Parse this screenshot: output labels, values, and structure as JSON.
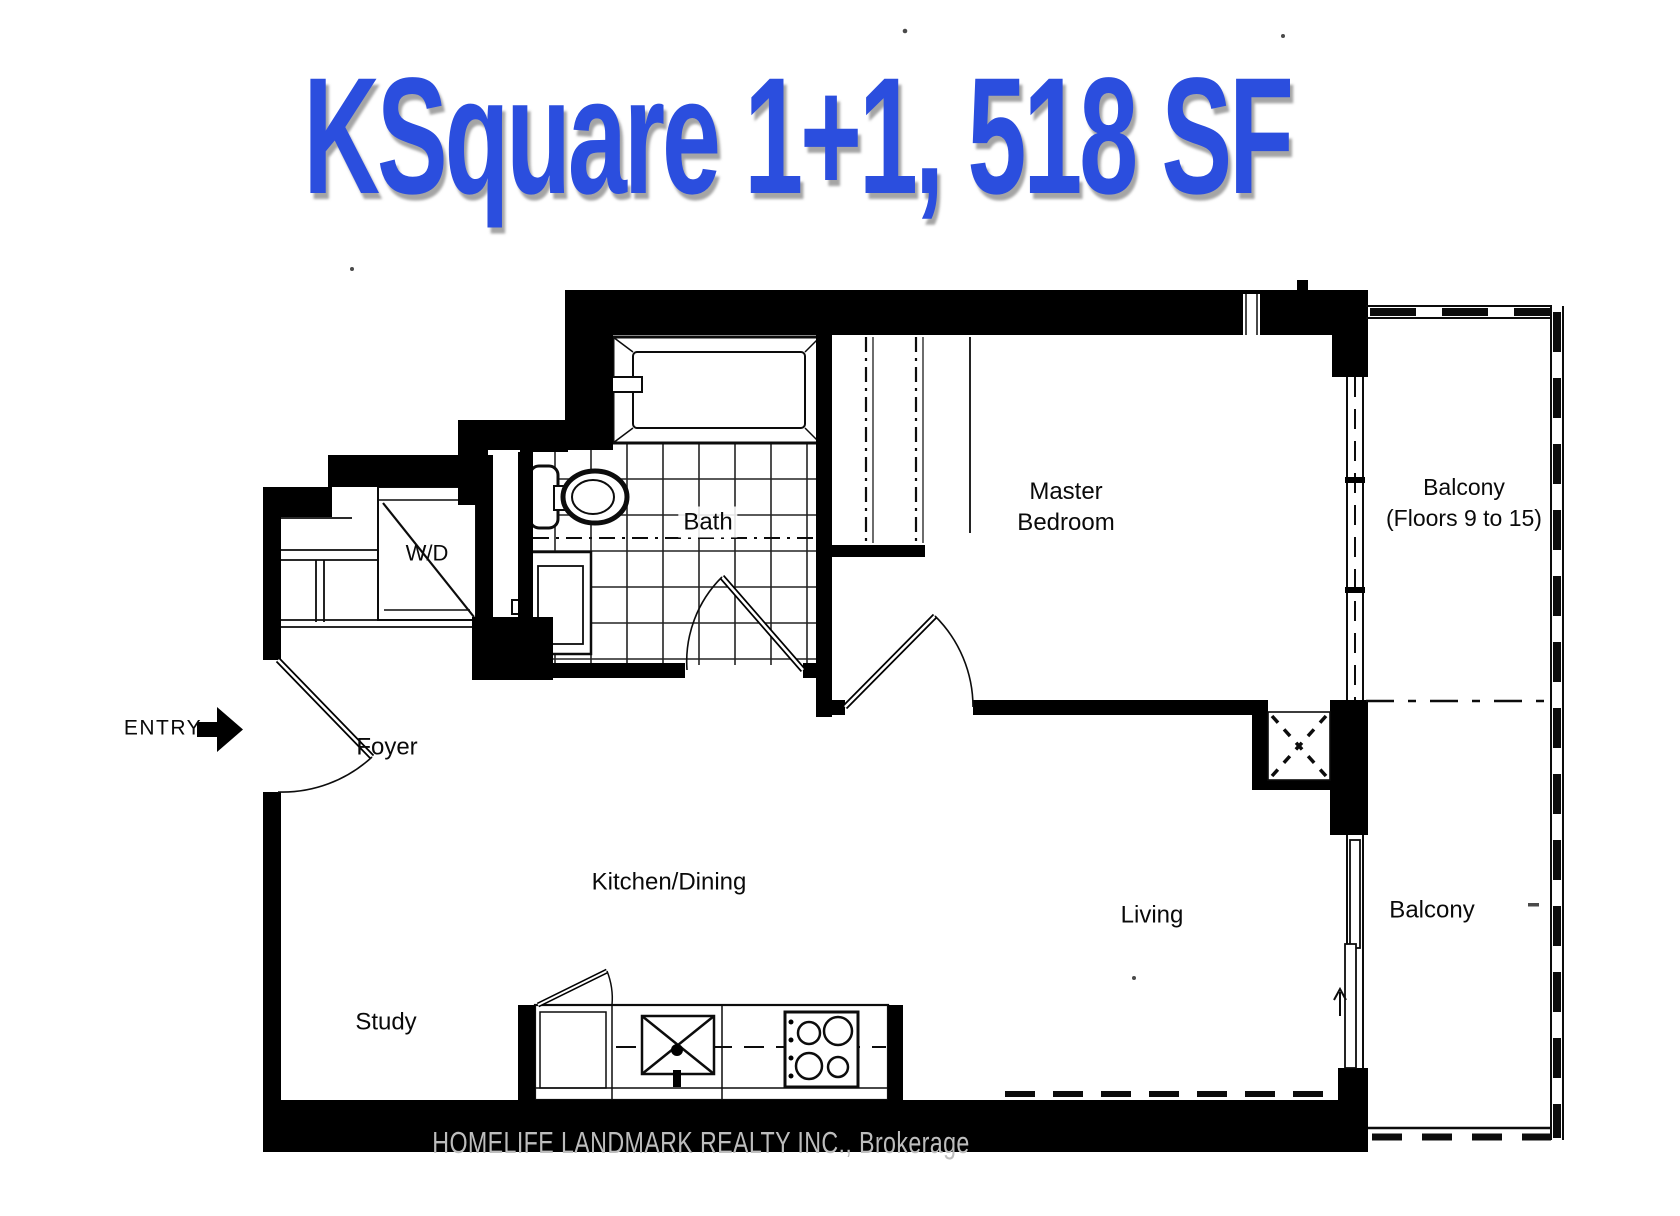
{
  "title": "KSquare 1+1, 518 SF",
  "entry_label": "ENTRY",
  "labels": {
    "foyer": "Foyer",
    "wd": "W/D",
    "bath": "Bath",
    "master_line1": "Master",
    "master_line2": "Bedroom",
    "kitchen_dining": "Kitchen/Dining",
    "living": "Living",
    "study": "Study",
    "balcony_upper_line1": "Balcony",
    "balcony_upper_line2": "(Floors 9 to 15)",
    "balcony_lower": "Balcony"
  },
  "watermark": "HOMELIFE LANDMARK REALTY INC., Brokerage",
  "icons": {
    "entry_arrow": "solid right-arrow",
    "balcony_door_arrow": "thin up-arrow",
    "shaft": "square with dashed X",
    "wd_unit": "square with diagonal",
    "sink": "box with X and faucet",
    "stove": "4-burner cooktop",
    "toilet": "tank and oval bowl",
    "bathtub": "double-line tub"
  },
  "colors": {
    "title_blue": "#2b4ede",
    "wall_black": "#000000",
    "line_black": "#0c0c0c",
    "watermark_gray": "#bdbdbd"
  }
}
